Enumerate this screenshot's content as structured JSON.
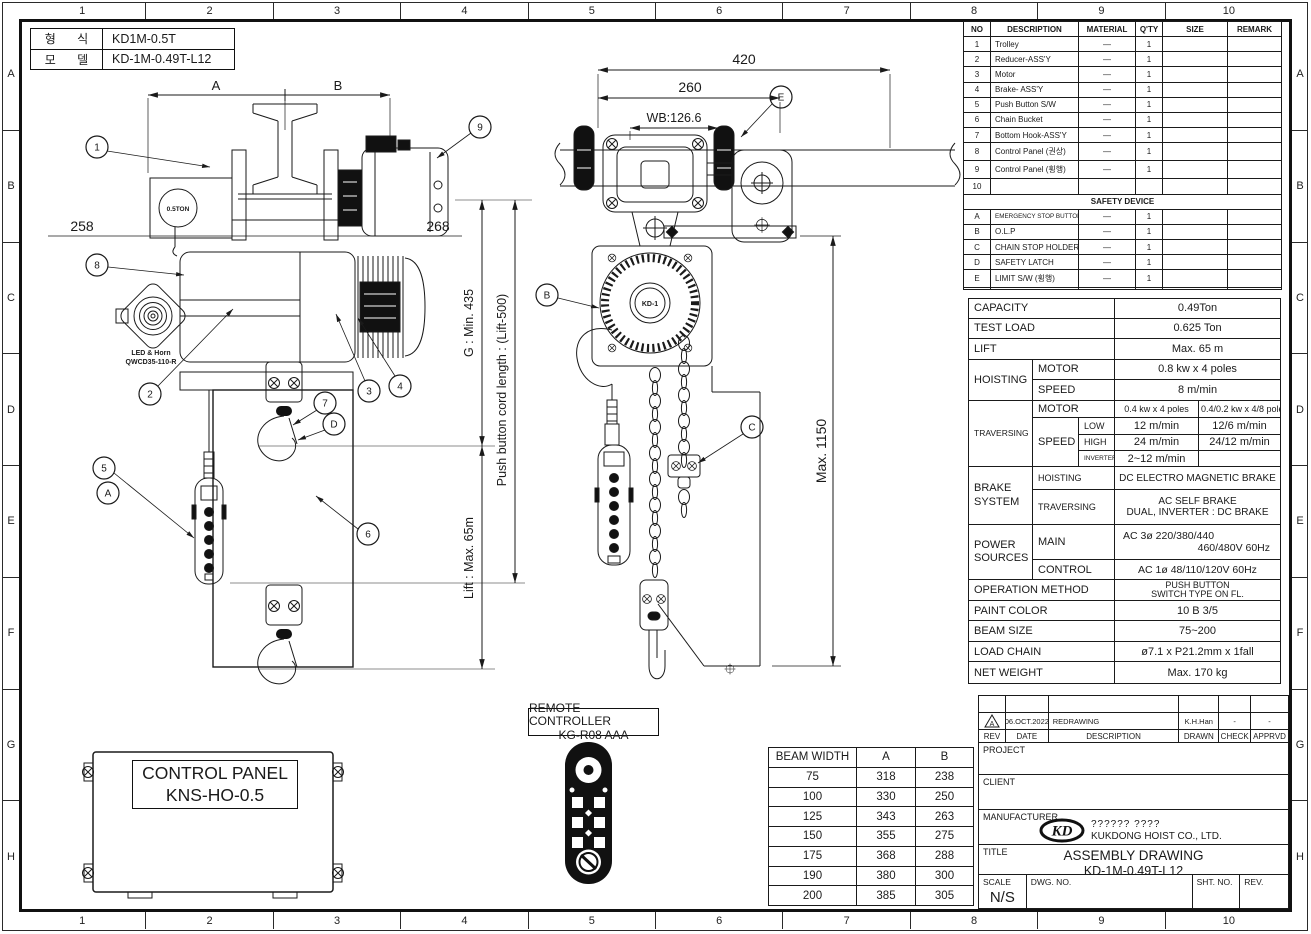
{
  "grid": {
    "columns": [
      "1",
      "2",
      "3",
      "4",
      "5",
      "6",
      "7",
      "8",
      "9",
      "10"
    ],
    "rows": [
      "A",
      "B",
      "C",
      "D",
      "E",
      "F",
      "G",
      "H"
    ]
  },
  "model_box": {
    "rows": [
      {
        "label": "형 식",
        "value": "KD1M-0.5T"
      },
      {
        "label": "모 델",
        "value": "KD-1M-0.49T-L12"
      }
    ]
  },
  "parts_table": {
    "headers": {
      "no": "NO",
      "description": "DESCRIPTION",
      "material": "MATERIAL",
      "qty": "Q'TY",
      "size": "SIZE",
      "remark": "REMARK"
    },
    "rows": [
      {
        "no": "1",
        "description": "Trolley",
        "material": "—",
        "qty": "1"
      },
      {
        "no": "2",
        "description": "Reducer-ASS'Y",
        "material": "—",
        "qty": "1"
      },
      {
        "no": "3",
        "description": "Motor",
        "material": "—",
        "qty": "1"
      },
      {
        "no": "4",
        "description": "Brake- ASS'Y",
        "material": "—",
        "qty": "1"
      },
      {
        "no": "5",
        "description": "Push Button S/W",
        "material": "—",
        "qty": "1"
      },
      {
        "no": "6",
        "description": "Chain Bucket",
        "material": "—",
        "qty": "1"
      },
      {
        "no": "7",
        "description": "Bottom Hook-ASS'Y",
        "material": "—",
        "qty": "1"
      },
      {
        "no": "8",
        "description": "Control Panel (권상)",
        "material": "—",
        "qty": "1"
      },
      {
        "no": "9",
        "description": "Control Panel (횡행)",
        "material": "—",
        "qty": "1"
      },
      {
        "no": "10",
        "description": "",
        "material": "",
        "qty": ""
      }
    ],
    "safety_header": "SAFETY DEVICE",
    "safety_rows": [
      {
        "no": "A",
        "description": "EMERGENCY STOP BUTTON S/W",
        "material": "—",
        "qty": "1"
      },
      {
        "no": "B",
        "description": "O.L.P",
        "material": "—",
        "qty": "1"
      },
      {
        "no": "C",
        "description": "CHAIN STOP HOLDER",
        "material": "—",
        "qty": "1"
      },
      {
        "no": "D",
        "description": "SAFETY LATCH",
        "material": "—",
        "qty": "1"
      },
      {
        "no": "E",
        "description": "LIMIT S/W (횡행)",
        "material": "—",
        "qty": "1"
      }
    ]
  },
  "spec_table": {
    "capacity_label": "CAPACITY",
    "capacity": "0.49Ton",
    "test_load_label": "TEST LOAD",
    "test_load": "0.625 Ton",
    "lift_label": "LIFT",
    "lift": "Max. 65 m",
    "hoisting_label": "HOISTING",
    "motor_label": "MOTOR",
    "speed_label": "SPEED",
    "hoisting_motor": "0.8 kw x 4 poles",
    "hoisting_speed": "8 m/min",
    "traversing_label": "TRAVERSING",
    "trav_motor_1": "0.4 kw x 4 poles",
    "trav_motor_2": "0.4/0.2 kw x 4/8 poles",
    "low_label": "LOW",
    "high_label": "HIGH",
    "inverter_label": "INVERTER",
    "trav_low_1": "12 m/min",
    "trav_low_2": "12/6 m/min",
    "trav_high_1": "24 m/min",
    "trav_high_2": "24/12 m/min",
    "trav_inverter": "2~12 m/min",
    "brake_label": "BRAKE SYSTEM",
    "brake_hoisting_label": "HOISTING",
    "brake_traversing_label": "TRAVERSING",
    "brake_hoisting": "DC ELECTRO MAGNETIC BRAKE",
    "brake_traversing_1": "AC SELF BRAKE",
    "brake_traversing_2": "DUAL, INVERTER : DC BRAKE",
    "power_label": "POWER SOURCES",
    "main_label": "MAIN",
    "control_label": "CONTROL",
    "power_main_1": "AC 3ø  220/380/440",
    "power_main_2": "460/480V 60Hz",
    "power_control": "AC 1ø 48/110/120V 60Hz",
    "operation_label": "OPERATION METHOD",
    "operation_1": "PUSH BUTTON",
    "operation_2": "SWITCH TYPE ON FL.",
    "paint_label": "PAINT COLOR",
    "paint": "10 B 3/5",
    "beam_size_label": "BEAM SIZE",
    "beam_size": "75~200",
    "load_chain_label": "LOAD CHAIN",
    "load_chain": "ø7.1 x P21.2mm x 1fall",
    "net_weight_label": "NET WEIGHT",
    "net_weight": "Max. 170 kg"
  },
  "beam_table": {
    "headers": [
      "BEAM WIDTH",
      "A",
      "B"
    ],
    "rows": [
      [
        "75",
        "318",
        "238"
      ],
      [
        "100",
        "330",
        "250"
      ],
      [
        "125",
        "343",
        "263"
      ],
      [
        "150",
        "355",
        "275"
      ],
      [
        "175",
        "368",
        "288"
      ],
      [
        "190",
        "380",
        "300"
      ],
      [
        "200",
        "385",
        "305"
      ]
    ]
  },
  "remote": {
    "title_1": "REMOTE CONTROLLER",
    "title_2": "KG-R08 AAA"
  },
  "control_panel": {
    "line_1": "CONTROL PANEL",
    "line_2": "KNS-HO-0.5"
  },
  "title_block": {
    "revision": {
      "mark": "A",
      "date": "06.OCT.2022",
      "description": "REDRAWING",
      "drawn": "K.H.Han",
      "check": "-",
      "apprvd": "-"
    },
    "headers": {
      "rev": "REV",
      "date": "DATE",
      "description": "DESCRIPTION",
      "drawn": "DRAWN",
      "check": "CHECK",
      "apprvd": "APPRVD"
    },
    "project_label": "PROJECT",
    "client_label": "CLIENT",
    "manufacturer_label": "MANUFACTURER",
    "logo_text": "KD",
    "manufacturer_1": "?????? ????",
    "manufacturer_2": "KUKDONG HOIST CO., LTD.",
    "title_label": "TITLE",
    "title_1": "ASSEMBLY DRAWING",
    "title_2": "KD-1M-0.49T-L12",
    "scale_label": "SCALE",
    "scale": "N/S",
    "dwg_label": "DWG. NO.",
    "sht_label": "SHT. NO.",
    "rev_label": "REV."
  },
  "drawing": {
    "dims": {
      "a": "A",
      "b": "B",
      "left": "258",
      "right": "268",
      "overall": "420",
      "inner": "260",
      "wheelbase": "WB:126.6",
      "height": "Max. 1150",
      "headroom": "G : Min. 435",
      "cord": "Push button cord length : (Lift-500)",
      "lift": "Lift : Max. 65m"
    },
    "labels": {
      "hook_capacity": "0.5TON",
      "horn_1": "LED & Horn",
      "horn_2": "QWCD35-110-R",
      "fan_hub": "KD-1"
    },
    "balloons": {
      "b1": "1",
      "b2": "2",
      "b3": "3",
      "b4": "4",
      "b5": "5",
      "b6": "6",
      "b7": "7",
      "b8": "8",
      "b9": "9",
      "bA": "A",
      "bB": "B",
      "bC": "C",
      "bD": "D",
      "bE": "E"
    }
  }
}
